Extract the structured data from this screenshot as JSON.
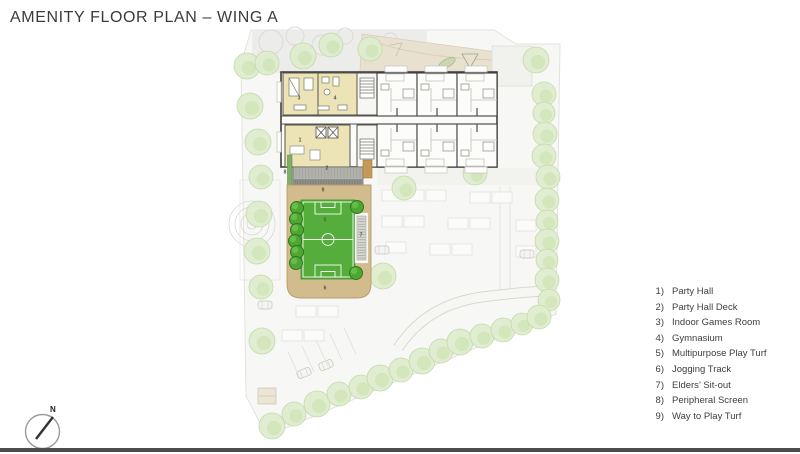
{
  "title": "AMENITY FLOOR PLAN – WING A",
  "legend": {
    "items": [
      {
        "number": "1)",
        "label": "Party Hall"
      },
      {
        "number": "2)",
        "label": "Party Hall Deck"
      },
      {
        "number": "3)",
        "label": "Indoor Games Room"
      },
      {
        "number": "4)",
        "label": "Gymnasium"
      },
      {
        "number": "5)",
        "label": "Multipurpose Play Turf"
      },
      {
        "number": "6)",
        "label": "Jogging Track"
      },
      {
        "number": "7)",
        "label": "Elders’ Sit-out"
      },
      {
        "number": "8)",
        "label": "Peripheral Screen"
      },
      {
        "number": "9)",
        "label": "Way to Play Turf"
      }
    ]
  },
  "plan": {
    "markers": [
      "1",
      "2",
      "3",
      "4",
      "5",
      "6",
      "7",
      "8",
      "9"
    ]
  },
  "compass": {
    "north_label": "N"
  },
  "colors": {
    "turf_green": "#55ae3c",
    "track_tan": "#d3bc8c",
    "amenity_yellow": "#ece4b6",
    "deck_gray": "#b3b3ad",
    "dark_tree_green": "#4ea733",
    "light_tree_green": "#e0edcf",
    "wall_dark": "#3f3f3f",
    "title_text": "#3b3b3b",
    "bottom_bar": "#4c4c4c"
  }
}
